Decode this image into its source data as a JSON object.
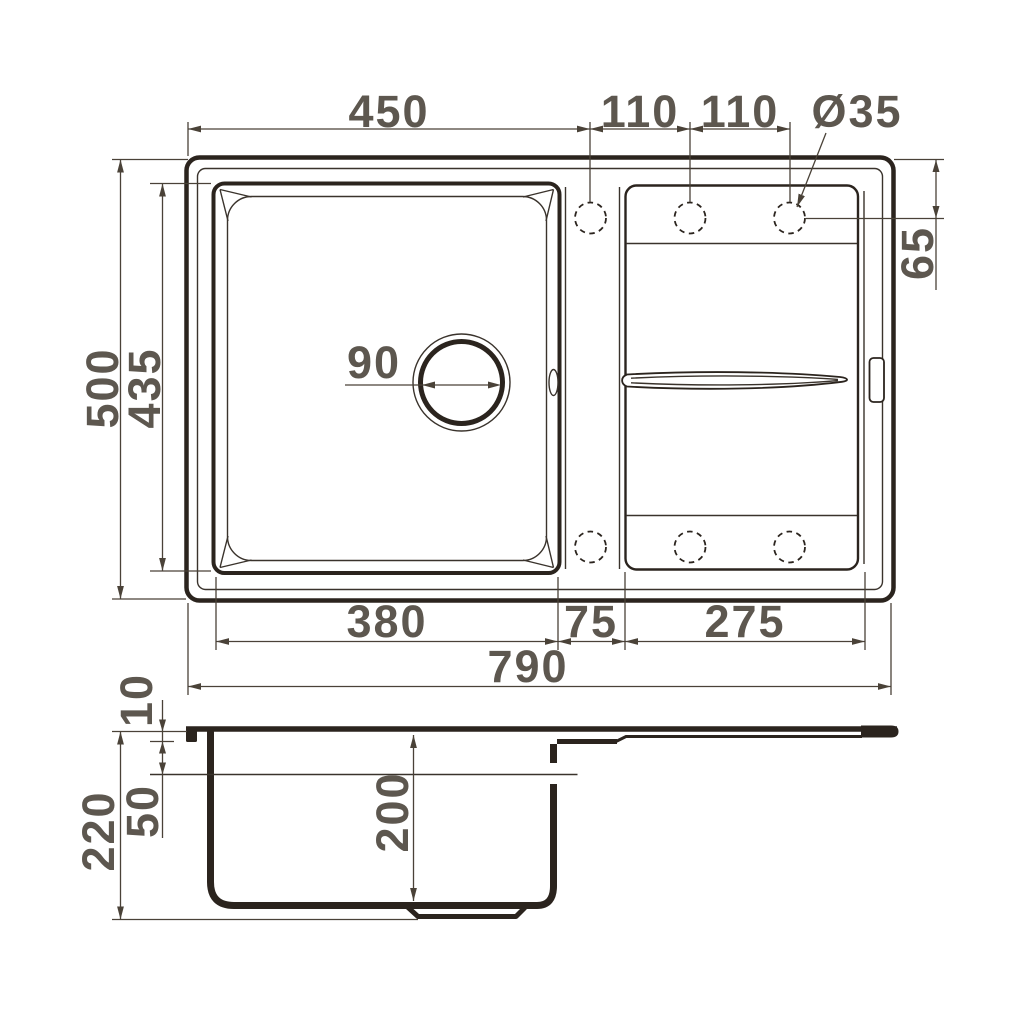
{
  "colors": {
    "line": "#2b241e",
    "dim_line": "#4a4238",
    "text": "#5d574f",
    "background": "#ffffff"
  },
  "dims": {
    "top": {
      "edge_to_hole1": "450",
      "hole1_to_hole2": "110",
      "hole2_to_hole3": "110",
      "hole_diameter": "Ø35",
      "hole_offset_from_edge": "65"
    },
    "left": {
      "sink_depth": "500",
      "bowl_inner_depth": "435"
    },
    "drain": {
      "drain_diameter": "90"
    },
    "bottom": {
      "bowl_width": "380",
      "divider_width": "75",
      "drainboard_width": "275",
      "sink_width": "790"
    },
    "side": {
      "rim_lip_thickness": "10",
      "ledge_depth": "50",
      "total_height": "220",
      "bowl_depth": "200"
    }
  }
}
